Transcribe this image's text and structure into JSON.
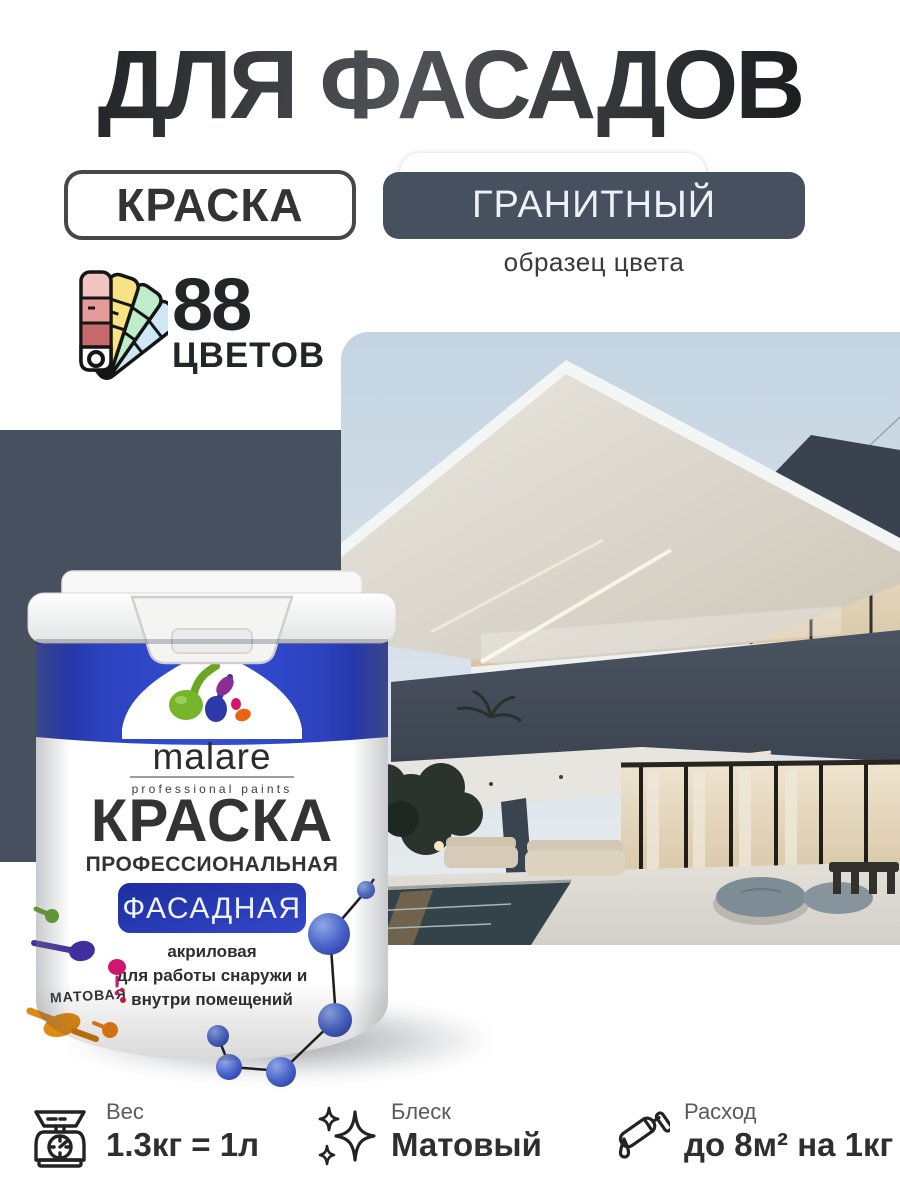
{
  "header": {
    "title": "ДЛЯ ФАСАДОВ"
  },
  "badges": {
    "product": "КРАСКА",
    "color_name": "ГРАНИТНЫЙ",
    "color_caption": "образец цвета"
  },
  "palette": {
    "count": "88",
    "label": "ЦВЕТОВ",
    "icon": "color-fan-icon"
  },
  "colors": {
    "granite_swatch": "#46505e",
    "brand_blue": "#2b3fbd",
    "badge_border": "#474747"
  },
  "can": {
    "brand": "malare",
    "brand_subtitle": "professional paints",
    "title": "КРАСКА",
    "subtitle": "ПРОФЕССИОНАЛЬНАЯ",
    "type_badge": "ФАСАДНАЯ",
    "desc_line1": "акриловая",
    "desc_line2": "для работы снаружи и",
    "desc_line3": "внутри помещений",
    "finish": "МАТОВАЯ"
  },
  "specs": [
    {
      "icon": "scale-icon",
      "label": "Вес",
      "value": "1.3кг = 1л"
    },
    {
      "icon": "sparkles-icon",
      "label": "Блеск",
      "value": "Матовый"
    },
    {
      "icon": "paint-roller-icon",
      "label": "Расход",
      "value": "до 8м² на 1кг"
    }
  ]
}
